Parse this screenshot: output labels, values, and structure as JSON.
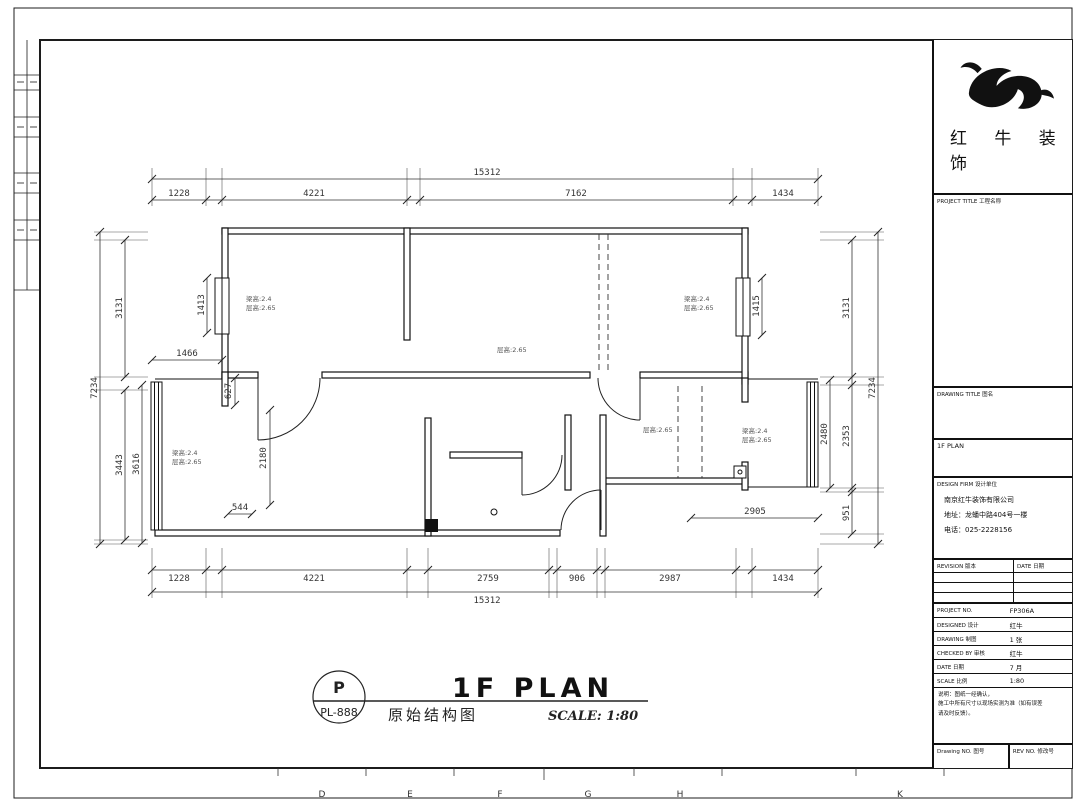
{
  "page": {
    "ruler_letters": [
      "D",
      "E",
      "F",
      "G",
      "H",
      "K"
    ]
  },
  "colors": {
    "ink": "#1c1c1c",
    "dim_text": "#333333",
    "background": "#ffffff"
  },
  "plan": {
    "dims": {
      "top_total": "15312",
      "top": [
        "1228",
        "4221",
        "7162",
        "1434"
      ],
      "bottom": [
        "1228",
        "4221",
        "2759",
        "906",
        "2987",
        "1434"
      ],
      "bottom_total": "15312",
      "left_total": "7234",
      "left_upper": "3131",
      "left_lower_a": "3443",
      "left_lower_b": "3616",
      "right_total": "7234",
      "right_upper": "3131",
      "right_mid": "2353",
      "right_lower": "951",
      "right_inner": "2480",
      "win_left": "1413",
      "win_right": "1415",
      "balc_left": "1466",
      "stub": "627",
      "room_ll_h": "2180",
      "door_ll": "544",
      "right_width": "2905"
    },
    "labels": {
      "room_tl": [
        "梁高:2.4",
        "层高:2.65"
      ],
      "room_tr": [
        "梁高:2.4",
        "层高:2.65"
      ],
      "room_ll": [
        "梁高:2.4",
        "层高:2.65"
      ],
      "room_rl": [
        "梁高:2.4",
        "层高:2.65"
      ],
      "hall": "层高:2.65",
      "right_mid": "层高:2.65"
    },
    "title": {
      "bubble_letter": "P",
      "bubble_code": "PL-888",
      "name": "1F PLAN",
      "name_cn": "原始结构图",
      "scale": "SCALE: 1:80"
    }
  },
  "titleblock": {
    "brand_line1": "红 牛 装",
    "brand_line2": "饰",
    "project_title_label": "PROJECT TITLE  工程名称",
    "drawing_title_label": "DRAWING TITLE  图名",
    "drawing_name": "1F PLAN",
    "design_firm_label": "DESIGN FIRM  设计单位",
    "company": "南京红牛装饰有限公司",
    "address": "地址：龙蟠中路404号一楼",
    "phone": "电话：025-2228156",
    "revision_label": "REVISION  版本",
    "date_label": "DATE  日期",
    "rows": [
      {
        "label": "PROJECT NO.",
        "value": "FP306A"
      },
      {
        "label": "DESIGNED  设计",
        "value": "红牛"
      },
      {
        "label": "DRAWING  制图",
        "value": "1 张"
      },
      {
        "label": "CHECKED BY  审核",
        "value": "红牛"
      },
      {
        "label": "DATE  日期",
        "value": "7 月"
      },
      {
        "label": "SCALE  比例",
        "value": "1:80"
      }
    ],
    "notes": [
      "说明：图纸一经确认，",
      "施工中所有尺寸以现场实测为准（如有误差",
      "请及时反馈）。"
    ],
    "footer_left": "Drawing NO.  图号",
    "footer_right": "REV NO.  修改号"
  }
}
